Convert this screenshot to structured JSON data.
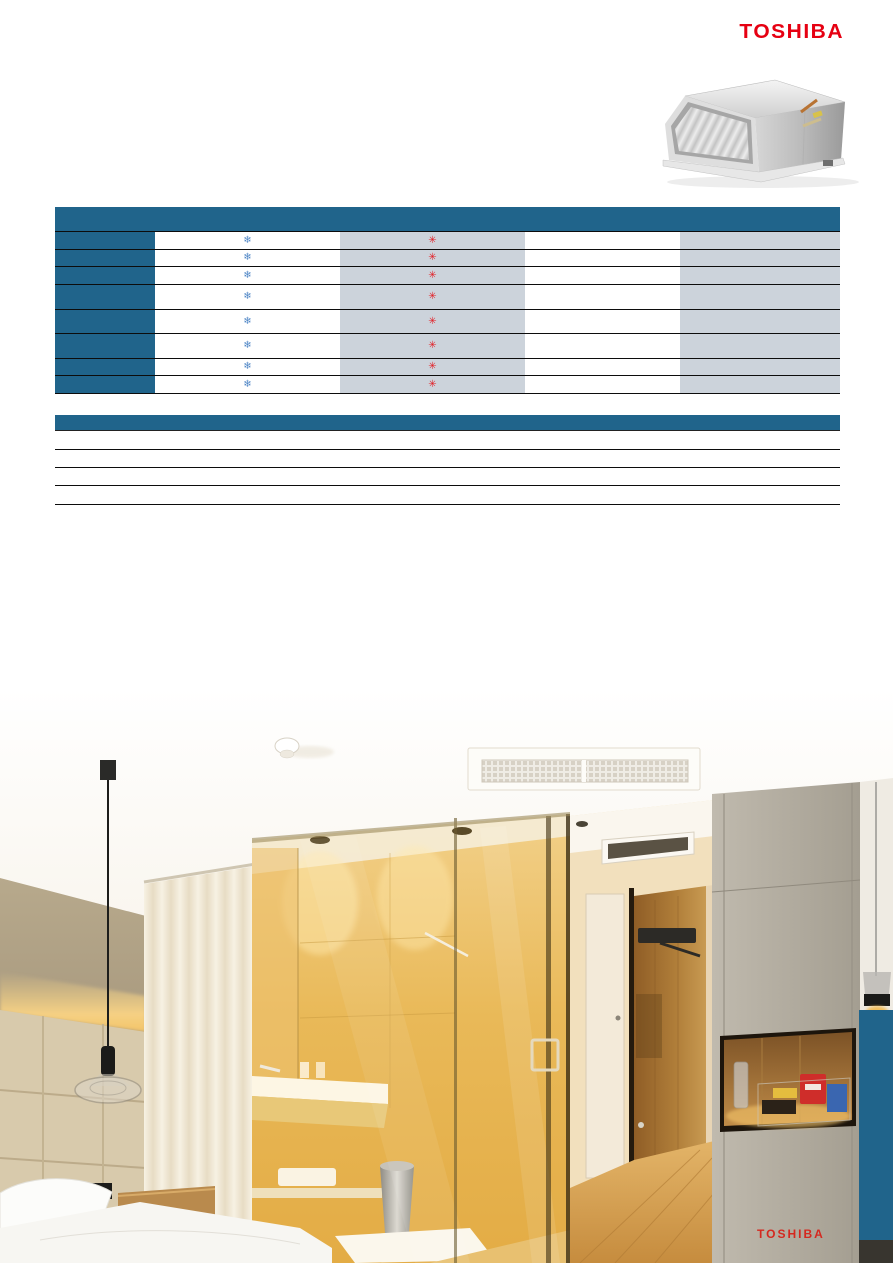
{
  "brand": {
    "logo_text": "TOSHIBA"
  },
  "colors": {
    "toshiba_red": "#e60012",
    "table_header_blue": "#20648b",
    "table_gray_column": "#ccd3db",
    "snowflake_blue": "#4f86c6",
    "asterisk_red": "#e22128",
    "photo_side_tab_blue": "#20648b",
    "photo_watermark_red": "#d5281f"
  },
  "product_image": {
    "name": "ducted-indoor-unit"
  },
  "spec_table": {
    "row_count": 8,
    "icons": {
      "snowflake": "❄",
      "asterisk": "✳"
    }
  },
  "info_table": {
    "row_count": 4
  },
  "photo": {
    "watermark_text": "TOSHIBA"
  }
}
